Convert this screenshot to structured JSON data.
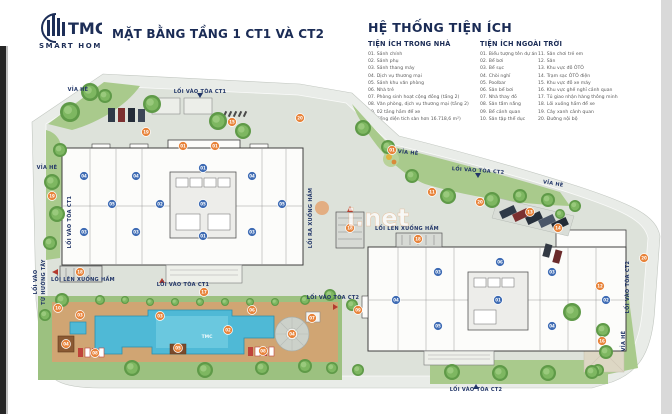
{
  "header": {
    "logo_name": "TMC",
    "logo_sub": "SMART HOME",
    "title": "MẶT BẰNG TẦNG 1 CT1 VÀ CT2"
  },
  "legend": {
    "title": "HỆ THỐNG TIỆN ÍCH",
    "indoor": {
      "title": "TIỆN ÍCH TRONG NHÀ",
      "items": [
        "01. Sảnh chính",
        "02. Sảnh phụ",
        "03. Sảnh thang máy",
        "04. Dịch vụ thương mại",
        "05. Sảnh khu văn phòng",
        "06. Nhà trẻ",
        "07. Phòng sinh hoạt cộng đồng (tầng 2)",
        "08. Văn phòng, dịch vụ thương mại (tầng 2)",
        "09. 02 tầng hầm để xe"
      ],
      "note": "(Tổng diện tích sàn hơn 16.718,6 m²)"
    },
    "outdoor": {
      "title": "TIỆN ÍCH NGOÀI TRỜI",
      "col1": [
        "01. Biểu tượng tên dự án",
        "02. Bể bơi",
        "03. Bể sục",
        "04. Chòi nghỉ",
        "05. Poolbar",
        "06. Sân bể bơi",
        "07. Nhà thay đồ",
        "08. Sân tắm nắng",
        "09. Bể cảnh quan",
        "10. Sân tập thể dục"
      ],
      "col2": [
        "11. Sân chơi trẻ em",
        "12. Sân",
        "13. Khu vực đỗ ÔTÔ",
        "14. Trạm sạc ÔTÔ điện",
        "15. Khu vực đỗ xe máy",
        "16. Khu vực ghế nghỉ cảnh quan",
        "17. Tủ giao nhận hàng thông minh",
        "18. Lối xuống hầm để xe",
        "19. Cây xanh cảnh quan",
        "20. Đường nội bộ"
      ]
    }
  },
  "plan": {
    "pool_logo": "TMC",
    "watermark": "i.net",
    "labels": [
      {
        "t": "VỈA HÈ",
        "x": 78,
        "y": 91,
        "r": 0
      },
      {
        "t": "LỐI VÀO TÒA CT1",
        "x": 200,
        "y": 93,
        "r": 0
      },
      {
        "t": "VỈA HÈ",
        "x": 47,
        "y": 169,
        "r": 0
      },
      {
        "t": "LỐI VÀO TÒA CT1",
        "x": 71,
        "y": 222,
        "r": -90
      },
      {
        "t": "LỐI VÀO",
        "x": 37,
        "y": 282,
        "r": -90
      },
      {
        "t": "TỪ HƯỚNG TÂY",
        "x": 45,
        "y": 282,
        "r": -90
      },
      {
        "t": "LỐI LÊN XUỐNG HẦM",
        "x": 83,
        "y": 281,
        "r": 0
      },
      {
        "t": "LỐI VÀO TÒA CT1",
        "x": 183,
        "y": 286,
        "r": 0
      },
      {
        "t": "LỐI RA XUỐNG HẦM",
        "x": 312,
        "y": 218,
        "r": -90
      },
      {
        "t": "VỈA HÈ",
        "x": 408,
        "y": 154,
        "r": 6
      },
      {
        "t": "LỐI VÀO TÒA CT2",
        "x": 478,
        "y": 172,
        "r": 4
      },
      {
        "t": "VỈA HÈ",
        "x": 553,
        "y": 185,
        "r": 10
      },
      {
        "t": "LỐI LÊN XUỐNG HẦM",
        "x": 407,
        "y": 230,
        "r": 0
      },
      {
        "t": "LỐI VÀO TÒA CT2",
        "x": 333,
        "y": 299,
        "r": 0
      },
      {
        "t": "LỐI VÀO TÒA CT2",
        "x": 629,
        "y": 287,
        "r": -90
      },
      {
        "t": "VỈA HÈ",
        "x": 625,
        "y": 341,
        "r": -90
      },
      {
        "t": "LỐI VÀO TÒA CT2",
        "x": 476,
        "y": 391,
        "r": 0
      }
    ],
    "markers_outdoor": [
      {
        "n": "01",
        "x": 392,
        "y": 150
      },
      {
        "n": "01",
        "x": 183,
        "y": 146
      },
      {
        "n": "01",
        "x": 215,
        "y": 146
      },
      {
        "n": "02",
        "x": 228,
        "y": 330
      },
      {
        "n": "03",
        "x": 80,
        "y": 315
      },
      {
        "n": "03",
        "x": 160,
        "y": 316
      },
      {
        "n": "04",
        "x": 292,
        "y": 334
      },
      {
        "n": "04",
        "x": 66,
        "y": 344
      },
      {
        "n": "05",
        "x": 178,
        "y": 348
      },
      {
        "n": "06",
        "x": 252,
        "y": 310
      },
      {
        "n": "07",
        "x": 312,
        "y": 318
      },
      {
        "n": "08",
        "x": 95,
        "y": 353
      },
      {
        "n": "08",
        "x": 263,
        "y": 351
      },
      {
        "n": "09",
        "x": 358,
        "y": 310
      },
      {
        "n": "10",
        "x": 58,
        "y": 308
      },
      {
        "n": "11",
        "x": 432,
        "y": 192
      },
      {
        "n": "12",
        "x": 600,
        "y": 286
      },
      {
        "n": "13",
        "x": 530,
        "y": 212
      },
      {
        "n": "14",
        "x": 558,
        "y": 228
      },
      {
        "n": "15",
        "x": 232,
        "y": 122
      },
      {
        "n": "16",
        "x": 602,
        "y": 341
      },
      {
        "n": "17",
        "x": 204,
        "y": 292
      },
      {
        "n": "18",
        "x": 80,
        "y": 272
      },
      {
        "n": "18",
        "x": 350,
        "y": 228
      },
      {
        "n": "18",
        "x": 418,
        "y": 239
      },
      {
        "n": "19",
        "x": 146,
        "y": 132
      },
      {
        "n": "19",
        "x": 52,
        "y": 196
      },
      {
        "n": "20",
        "x": 300,
        "y": 118
      },
      {
        "n": "20",
        "x": 480,
        "y": 202
      },
      {
        "n": "20",
        "x": 644,
        "y": 258
      }
    ],
    "markers_indoor": [
      {
        "n": "04",
        "x": 84,
        "y": 176
      },
      {
        "n": "03",
        "x": 84,
        "y": 232
      },
      {
        "n": "05",
        "x": 112,
        "y": 204
      },
      {
        "n": "04",
        "x": 136,
        "y": 176
      },
      {
        "n": "03",
        "x": 136,
        "y": 232
      },
      {
        "n": "02",
        "x": 160,
        "y": 204
      },
      {
        "n": "01",
        "x": 203,
        "y": 168
      },
      {
        "n": "05",
        "x": 203,
        "y": 204
      },
      {
        "n": "01",
        "x": 203,
        "y": 236
      },
      {
        "n": "04",
        "x": 252,
        "y": 176
      },
      {
        "n": "03",
        "x": 252,
        "y": 232
      },
      {
        "n": "05",
        "x": 282,
        "y": 204
      },
      {
        "n": "04",
        "x": 396,
        "y": 300
      },
      {
        "n": "03",
        "x": 438,
        "y": 272
      },
      {
        "n": "05",
        "x": 438,
        "y": 326
      },
      {
        "n": "01",
        "x": 498,
        "y": 300
      },
      {
        "n": "03",
        "x": 552,
        "y": 272
      },
      {
        "n": "04",
        "x": 552,
        "y": 326
      },
      {
        "n": "06",
        "x": 500,
        "y": 262
      },
      {
        "n": "02",
        "x": 606,
        "y": 300
      }
    ],
    "colors": {
      "navy": "#1a2b55",
      "label_navy": "#223668",
      "marker_orange": "#e8833a",
      "marker_blue": "#3f6cb4",
      "pool_blue": "#4fb9d6",
      "green": "#a9ca8c",
      "deck_tan": "#d0a573"
    }
  }
}
